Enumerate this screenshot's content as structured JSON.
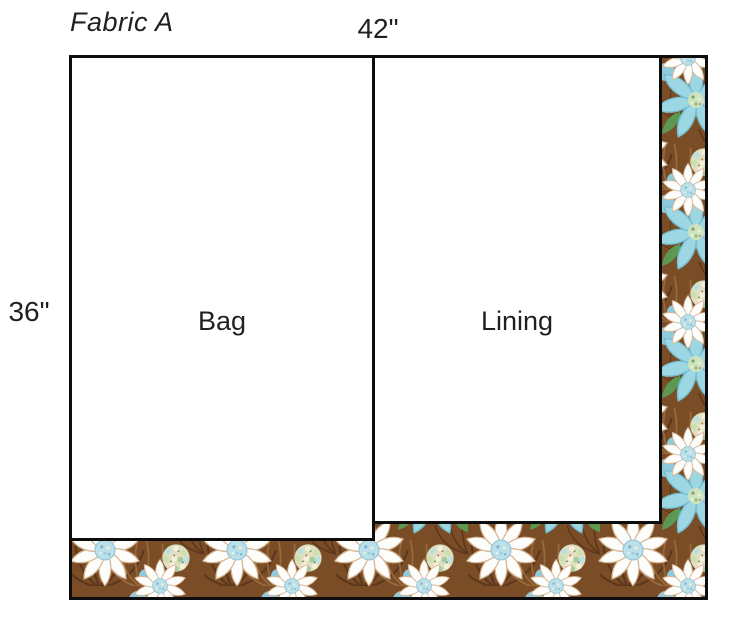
{
  "diagram": {
    "title": "Fabric A",
    "width_dimension": "42\"",
    "height_dimension": "36\"",
    "pieces": [
      {
        "label": "Bag"
      },
      {
        "label": "Lining"
      }
    ]
  },
  "fabric_colors": {
    "brown_base": "#7b4d26",
    "brown_dark": "#58331a",
    "brown_light": "#9c6d3e",
    "turquoise": "#9ed7e4",
    "turquoise_edge": "#74bed2",
    "white_petal": "#fdfdfb",
    "petal_shadow": "#d8b795",
    "cream": "#efe8d2",
    "leaf_green": "#5c9852",
    "blob_blue": "#8fcbdc",
    "border_black": "#0d0d0d"
  }
}
